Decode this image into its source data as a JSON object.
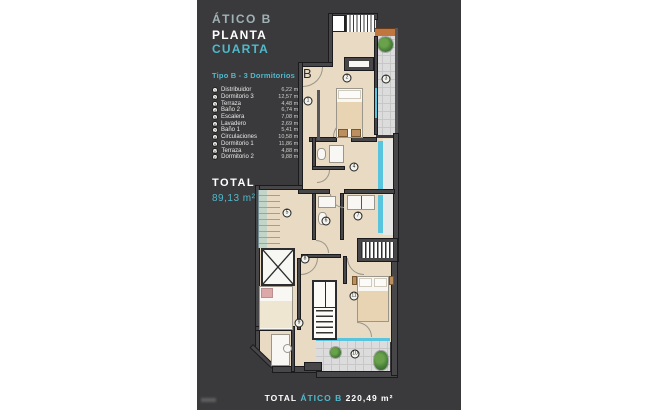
{
  "header": {
    "title": "ÁTICO B",
    "floor_white": "PLANTA",
    "floor_teal": "CUARTA",
    "type_label": "Tipo B - 3 Dormitorios"
  },
  "rooms": [
    {
      "num": "1",
      "name": "Distribuidor",
      "area": "6,22 m²"
    },
    {
      "num": "2",
      "name": "Dormitorio 3",
      "area": "12,57 m²"
    },
    {
      "num": "3",
      "name": "Terraza",
      "area": "4,48 m²"
    },
    {
      "num": "4",
      "name": "Baño 2",
      "area": "6,74 m²"
    },
    {
      "num": "5",
      "name": "Escalera",
      "area": "7,08 m²"
    },
    {
      "num": "6",
      "name": "Lavadero",
      "area": "2,69 m²"
    },
    {
      "num": "7",
      "name": "Baño 1",
      "area": "5,41 m²"
    },
    {
      "num": "8",
      "name": "Circulaciones",
      "area": "10,58 m²"
    },
    {
      "num": "9",
      "name": "Dormitorio 1",
      "area": "11,86 m²"
    },
    {
      "num": "10",
      "name": "Terraza",
      "area": "4,88 m²"
    },
    {
      "num": "11",
      "name": "Dormitorio 2",
      "area": "9,88 m²"
    }
  ],
  "total": {
    "label": "TOTAL",
    "value": "89,13 m²"
  },
  "footer": {
    "label": "TOTAL",
    "name": "ÁTICO B",
    "area": "220,49 m²"
  },
  "plan": {
    "unit_label": "B",
    "markers": [
      {
        "n": "1",
        "x": 111,
        "y": 101
      },
      {
        "n": "2",
        "x": 150,
        "y": 78
      },
      {
        "n": "3",
        "x": 189,
        "y": 79
      },
      {
        "n": "4",
        "x": 157,
        "y": 167
      },
      {
        "n": "5",
        "x": 90,
        "y": 213
      },
      {
        "n": "6",
        "x": 129,
        "y": 221
      },
      {
        "n": "7",
        "x": 161,
        "y": 216
      },
      {
        "n": "8",
        "x": 108,
        "y": 259
      },
      {
        "n": "9",
        "x": 102,
        "y": 323
      },
      {
        "n": "10",
        "x": 158,
        "y": 354
      },
      {
        "n": "11",
        "x": 157,
        "y": 296
      }
    ]
  },
  "colors": {
    "accent": "#4fb9cc",
    "panel_bg": "#3a3a3c",
    "floor": "#e9dac3",
    "terrace": "#dcdcdc",
    "glass": "#58c4de",
    "orange": "#c0763f"
  }
}
